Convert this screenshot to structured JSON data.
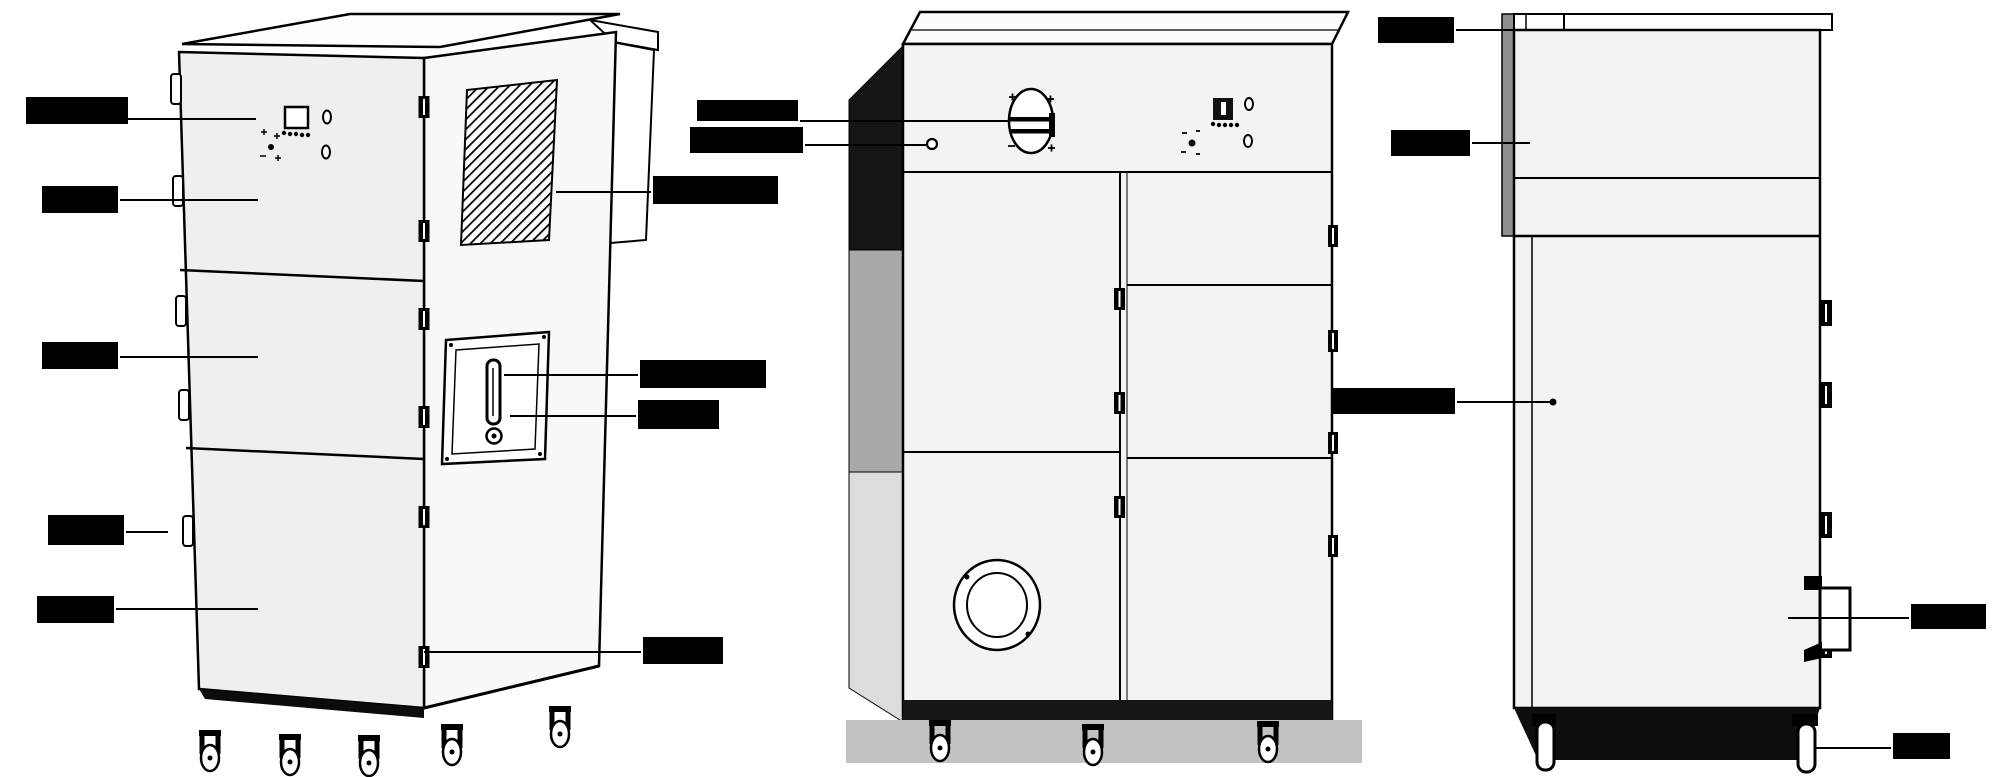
{
  "diagram": {
    "type": "three-view technical diagram",
    "colors": {
      "line": "#000000",
      "panel_fill": "#f2f2f2",
      "side_fill": "#f8f8f8",
      "dark_base": "#111111",
      "shadow": "#c2c2c2",
      "duct_gray": "#8f8f8f"
    }
  },
  "labels": {
    "control_panel": "控制面板",
    "upper_cabinet": "上箱体",
    "middle_cabinet": "中箱体",
    "door_hinge": "门铰链",
    "lower_cabinet": "下箱体",
    "air_outlet_grille": "洁净排风口",
    "cleaning_handle": "清灰机构手柄",
    "handle_lock": "把手锁",
    "ground_port": "接地口",
    "damper_valve": "风量调节阀",
    "pressure_test_port": "压差检测口",
    "air_outlet": "出风口",
    "noise_reduction_duct": "降噪管",
    "hv_test_port": "高压检测口",
    "cable_inlet": "进线口",
    "caster": "脚轮"
  }
}
